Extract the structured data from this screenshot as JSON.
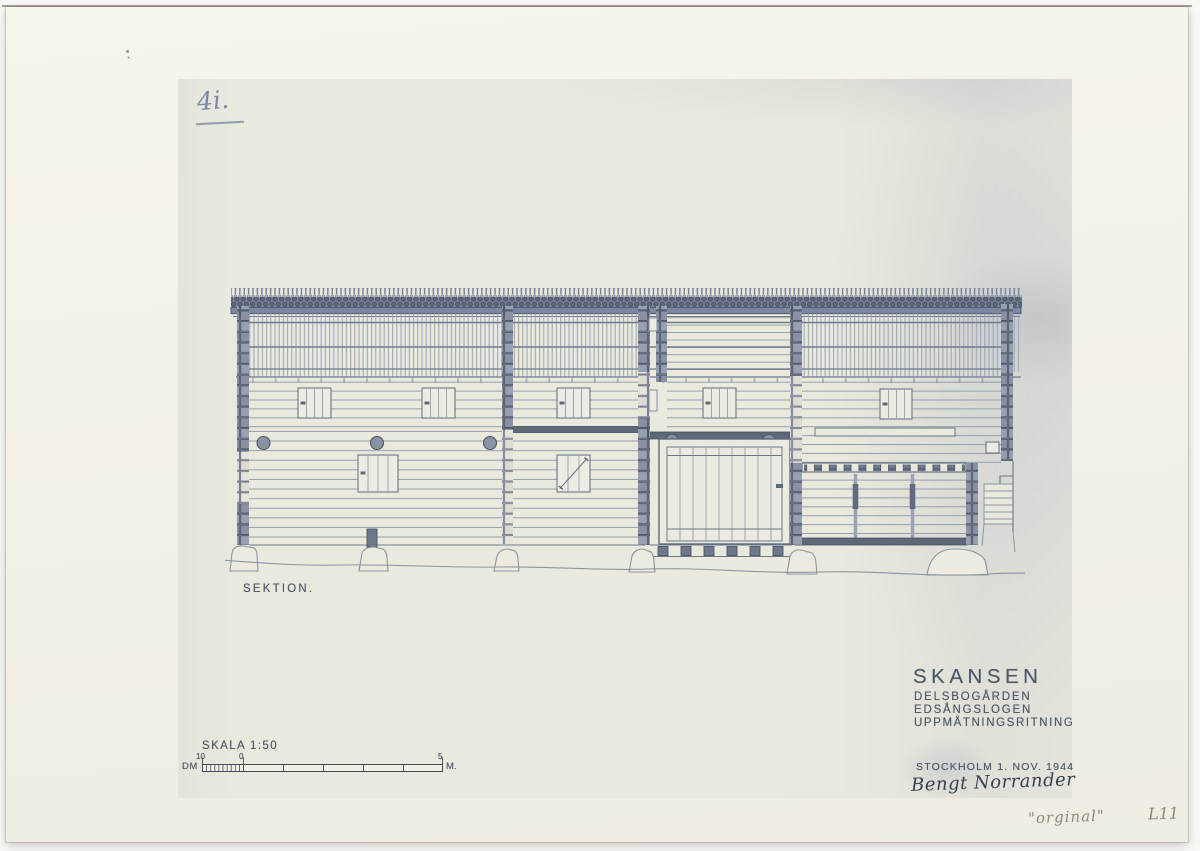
{
  "page": {
    "annotation_top_left": "4i.",
    "caption": "SEKTION.",
    "scale": {
      "label": "SKALA 1:50",
      "unit_left": "DM",
      "unit_right": "M.",
      "ticks": [
        "10",
        "0",
        "5"
      ]
    },
    "title_block": {
      "title": "SKANSEN",
      "subtitle1": "DELSBOGÅRDEN",
      "subtitle2": "EDSÅNGSLOGEN",
      "subtitle3": "UPPMÅTNINGSRITNING",
      "place_date": "STOCKHOLM 1. NOV. 1944",
      "signature": "Bengt Norrander"
    },
    "pencil_notes": {
      "quote": "\"orginal\"",
      "code": "L11"
    }
  },
  "colors": {
    "ink": "#4b5668",
    "pencil_blue": "#7a87a6",
    "pencil_gray": "#8d887a",
    "paper_mat": "#f3f0e7",
    "paper_print": "#eae9de",
    "drawing_line": "#6b7688",
    "post_fill": "#97a0b0",
    "dark_beam": "#5d6878"
  }
}
